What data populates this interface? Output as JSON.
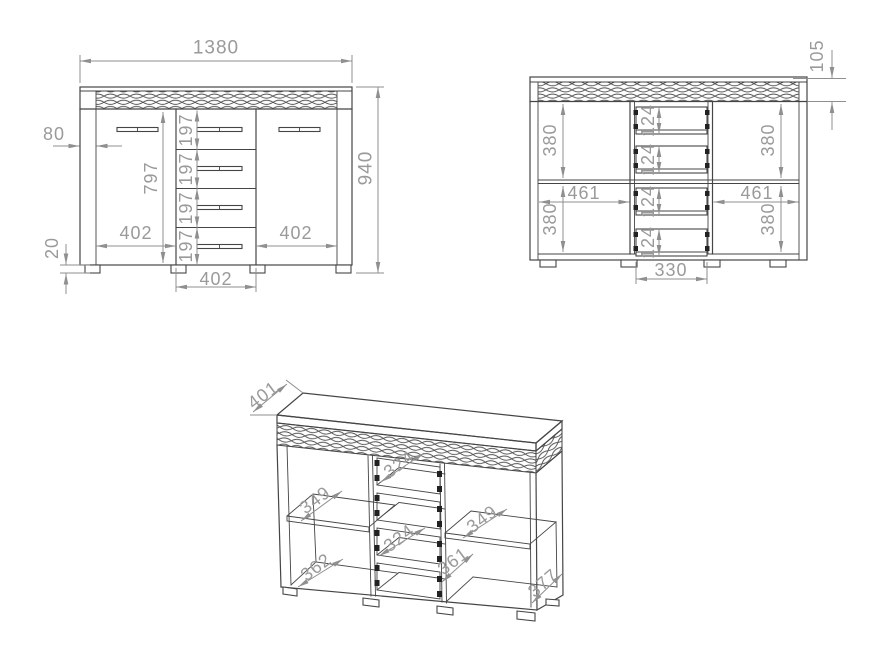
{
  "drawing_title": "sideboard-technical-drawing",
  "colors": {
    "line": "#454545",
    "dimension": "#8f8f8f",
    "dim_text": "#9a9a9a",
    "background": "#ffffff"
  },
  "front_view": {
    "overall_width": "1380",
    "overall_height": "940",
    "side_stile_width": "80",
    "door_height": "797",
    "left_door_width": "402",
    "right_door_width": "402",
    "drawer_column_width": "402",
    "drawer_front_heights": [
      "197",
      "197",
      "197",
      "197"
    ],
    "foot_height": "20"
  },
  "internal_view": {
    "top_band_height": "105",
    "upper_left_height": "380",
    "lower_left_height": "380",
    "upper_right_height": "380",
    "lower_right_height": "380",
    "left_shelf_width": "461",
    "right_shelf_width": "461",
    "drawer_box_heights": [
      "124",
      "124",
      "124",
      "124"
    ],
    "center_base_width": "330"
  },
  "iso_view": {
    "top_depth": "401",
    "upper_drawer_depth": "324",
    "lower_drawer_depth": "324",
    "left_shelf_depth": "349",
    "right_shelf_depth": "349",
    "left_floor_depth": "362",
    "right_inner_depth": "361",
    "right_bottom_depth": "377"
  }
}
